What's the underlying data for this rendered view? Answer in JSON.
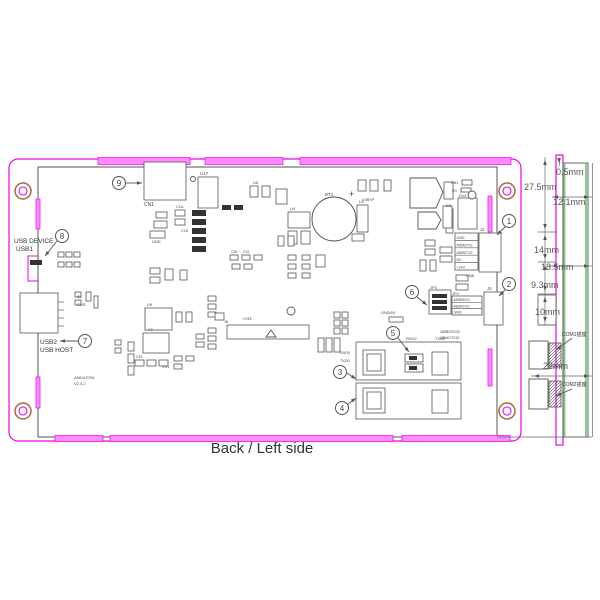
{
  "title": "Back / Left side",
  "colors": {
    "magenta": "#ee00ee",
    "magenta_fill": "#ff8cff",
    "line_gray": "#555555",
    "green": "#7cc97c",
    "hole_ring": "#a86a3a",
    "pad_dark": "#333333"
  },
  "left_labels": {
    "usb_device": "USB DEVICE",
    "usb1": "USB1",
    "usb2": "USB2",
    "usb_host": "USB HOST"
  },
  "side_view": {
    "com1_label": "COM1插座",
    "com2_label": "COM2插座"
  },
  "dimension_labels": [
    {
      "t": "27.5mm",
      "x": 524,
      "y": 190
    },
    {
      "t": "0.5mm",
      "x": 556,
      "y": 175
    },
    {
      "t": "12.1mm",
      "x": 553,
      "y": 205
    },
    {
      "t": "14mm",
      "x": 534,
      "y": 253
    },
    {
      "t": "18.5mm",
      "x": 541,
      "y": 270
    },
    {
      "t": "9.3mm",
      "x": 531,
      "y": 288
    },
    {
      "t": "10mm",
      "x": 535,
      "y": 315
    },
    {
      "t": "22mm",
      "x": 543,
      "y": 369
    }
  ],
  "callouts": [
    {
      "n": "1",
      "cx": 509,
      "cy": 221,
      "x1": 505,
      "y1": 227,
      "x2": 497,
      "y2": 235
    },
    {
      "n": "2",
      "cx": 509,
      "cy": 284,
      "x1": 505,
      "y1": 290,
      "x2": 499,
      "y2": 296
    },
    {
      "n": "3",
      "cx": 340,
      "cy": 372,
      "x1": 347,
      "y1": 373,
      "x2": 356,
      "y2": 379
    },
    {
      "n": "4",
      "cx": 342,
      "cy": 408,
      "x1": 348,
      "y1": 404,
      "x2": 356,
      "y2": 398
    },
    {
      "n": "5",
      "cx": 393,
      "cy": 333,
      "x1": 398,
      "y1": 338,
      "x2": 409,
      "y2": 352
    },
    {
      "n": "6",
      "cx": 412,
      "cy": 292,
      "x1": 417,
      "y1": 297,
      "x2": 427,
      "y2": 305
    },
    {
      "n": "7",
      "cx": 85,
      "cy": 341,
      "x1": 78,
      "y1": 341,
      "x2": 60,
      "y2": 341
    },
    {
      "n": "8",
      "cx": 62,
      "cy": 236,
      "x1": 57,
      "y1": 241,
      "x2": 45,
      "y2": 256
    },
    {
      "n": "9",
      "cx": 119,
      "cy": 183,
      "x1": 126,
      "y1": 183,
      "x2": 142,
      "y2": 183
    }
  ],
  "leader_arrows": [
    {
      "x1": 572,
      "y1": 338,
      "x2": 556,
      "y2": 350
    },
    {
      "x1": 572,
      "y1": 389,
      "x2": 556,
      "y2": 396
    }
  ],
  "dim_arrows": [
    {
      "x": 545,
      "y": 160,
      "dir": "up"
    },
    {
      "x": 545,
      "y": 229,
      "dir": "down"
    },
    {
      "x": 545,
      "y": 235,
      "dir": "up"
    },
    {
      "x": 545,
      "y": 259,
      "dir": "down"
    },
    {
      "x": 545,
      "y": 265,
      "dir": "up"
    },
    {
      "x": 545,
      "y": 291,
      "dir": "down"
    },
    {
      "x": 545,
      "y": 297,
      "dir": "up"
    },
    {
      "x": 545,
      "y": 322,
      "dir": "down"
    },
    {
      "x": 553,
      "y": 197,
      "dir": "left"
    },
    {
      "x": 589,
      "y": 197,
      "dir": "right"
    },
    {
      "x": 552,
      "y": 266,
      "dir": "left"
    },
    {
      "x": 589,
      "y": 266,
      "dir": "right"
    },
    {
      "x": 534,
      "y": 376,
      "dir": "left"
    },
    {
      "x": 589,
      "y": 376,
      "dir": "right"
    },
    {
      "x": 559,
      "y": 163,
      "dir": "down"
    }
  ],
  "connector_tables": [
    {
      "x": 456.5,
      "y0": 239,
      "dy": 7.4,
      "fs": 3.6,
      "pins": [
        "GND",
        "485A/TX2",
        "485B/TX2",
        "NC",
        "+24V"
      ]
    },
    {
      "x": 453.5,
      "y0": 301,
      "dy": 6.3,
      "fs": 3.6,
      "pins": [
        "485B/RX2",
        "485A/TX2",
        "GND"
      ]
    }
  ],
  "ref_labels": [
    {
      "t": "CN1",
      "x": 144,
      "y": 206,
      "s": 5
    },
    {
      "t": "U17",
      "x": 200,
      "y": 175,
      "s": 4.5
    },
    {
      "t": "BT1",
      "x": 325,
      "y": 196,
      "s": 4.5
    },
    {
      "t": "+",
      "x": 349,
      "y": 197,
      "s": 9
    },
    {
      "t": "U4",
      "x": 290,
      "y": 210,
      "s": 4
    },
    {
      "t": "L5",
      "x": 359,
      "y": 203,
      "s": 4
    },
    {
      "t": "V3RXP",
      "x": 362,
      "y": 201,
      "s": 3.8
    },
    {
      "t": "U6",
      "x": 253,
      "y": 184,
      "s": 4
    },
    {
      "t": "FB1",
      "x": 451,
      "y": 184,
      "s": 4
    },
    {
      "t": "R1",
      "x": 452,
      "y": 192,
      "s": 4
    },
    {
      "t": "D14",
      "x": 459,
      "y": 197,
      "s": 4
    },
    {
      "t": "D9",
      "x": 446,
      "y": 207,
      "s": 4
    },
    {
      "t": "J2",
      "x": 480,
      "y": 231,
      "s": 4.5
    },
    {
      "t": "CN6",
      "x": 466,
      "y": 277,
      "s": 4
    },
    {
      "t": "J4",
      "x": 487,
      "y": 290,
      "s": 4.5
    },
    {
      "t": "JP4",
      "x": 452,
      "y": 295,
      "s": 4
    },
    {
      "t": "JP3",
      "x": 430,
      "y": 289,
      "s": 4
    },
    {
      "t": "RXD2",
      "x": 406,
      "y": 340,
      "s": 4
    },
    {
      "t": "TXD2",
      "x": 435,
      "y": 340,
      "s": 4
    },
    {
      "t": "RXD0",
      "x": 340,
      "y": 354,
      "s": 3.8
    },
    {
      "t": "TXD0",
      "x": 340,
      "y": 362,
      "s": 3.8
    },
    {
      "t": "GND/5V",
      "x": 381,
      "y": 314,
      "s": 3.8
    },
    {
      "t": "+V33",
      "x": 242,
      "y": 320,
      "s": 4
    },
    {
      "t": "GND",
      "x": 152,
      "y": 243,
      "s": 3.8
    },
    {
      "t": "CLK",
      "x": 181,
      "y": 232,
      "s": 3.8
    },
    {
      "t": "C1A",
      "x": 176,
      "y": 208,
      "s": 3.8
    },
    {
      "t": "5V",
      "x": 77,
      "y": 298,
      "s": 3.8
    },
    {
      "t": "GND",
      "x": 77,
      "y": 306,
      "s": 3.8
    },
    {
      "t": "VS1",
      "x": 162,
      "y": 368,
      "s": 3.8
    },
    {
      "t": "Y2",
      "x": 148,
      "y": 331,
      "s": 3.8
    },
    {
      "t": "C43",
      "x": 136,
      "y": 358,
      "s": 3.5
    },
    {
      "t": "AMD470FA",
      "x": 74,
      "y": 379,
      "s": 4
    },
    {
      "t": "V2.4.2",
      "x": 74,
      "y": 385,
      "s": 4
    },
    {
      "t": "485B2/RX20",
      "x": 440,
      "y": 333,
      "s": 3.5
    },
    {
      "t": "485A2/TX20",
      "x": 440,
      "y": 339,
      "s": 3.5
    },
    {
      "t": "U9",
      "x": 147,
      "y": 306,
      "s": 4
    },
    {
      "t": "C30",
      "x": 231,
      "y": 253,
      "s": 3.5
    },
    {
      "t": "C31",
      "x": 243,
      "y": 253,
      "s": 3.5
    },
    {
      "t": "J6",
      "x": 224,
      "y": 323,
      "s": 4
    }
  ],
  "shapes": {
    "magenta_bars": [
      [
        98,
        157.5,
        92,
        7
      ],
      [
        205,
        157.5,
        78,
        7
      ],
      [
        300,
        157.5,
        211,
        7
      ],
      [
        55,
        435.5,
        48,
        6
      ],
      [
        110,
        435.5,
        283,
        6
      ],
      [
        402,
        435.5,
        108,
        6
      ],
      [
        36,
        199,
        4,
        30
      ],
      [
        36,
        377,
        4,
        31
      ],
      [
        488,
        196,
        4,
        36
      ],
      [
        488,
        349,
        4,
        37
      ]
    ],
    "holes": [
      [
        23,
        191
      ],
      [
        23,
        411
      ],
      [
        507,
        191
      ],
      [
        507,
        411
      ]
    ],
    "rects": [
      [
        144,
        162,
        42,
        38
      ],
      [
        198,
        177,
        20,
        31
      ],
      [
        288,
        212,
        22,
        16
      ],
      [
        288,
        231,
        9,
        13
      ],
      [
        301,
        231,
        9,
        13
      ],
      [
        357,
        205,
        11,
        27
      ],
      [
        352,
        234,
        12,
        7
      ],
      [
        446,
        209,
        7,
        24
      ],
      [
        444,
        182,
        9,
        17
      ],
      [
        458,
        198,
        19,
        31
      ],
      [
        443,
        206,
        9,
        22
      ],
      [
        462,
        180,
        10,
        5
      ],
      [
        461,
        188,
        10,
        4
      ],
      [
        358,
        180,
        8,
        11
      ],
      [
        370,
        180,
        8,
        11
      ],
      [
        384,
        180,
        7,
        11
      ],
      [
        250,
        186,
        8,
        11
      ],
      [
        262,
        186,
        8,
        11
      ],
      [
        276,
        189,
        11,
        15
      ],
      [
        455,
        233,
        23,
        37
      ],
      [
        479,
        233,
        22,
        39
      ],
      [
        440,
        247,
        12,
        6
      ],
      [
        440,
        256,
        12,
        6
      ],
      [
        425,
        240,
        10,
        6
      ],
      [
        425,
        249,
        10,
        6
      ],
      [
        456,
        275,
        12,
        6
      ],
      [
        456,
        284,
        12,
        6
      ],
      [
        420,
        260,
        6,
        11
      ],
      [
        430,
        260,
        6,
        11
      ],
      [
        452,
        296,
        30,
        19
      ],
      [
        484,
        292,
        19,
        33
      ],
      [
        429,
        290,
        22,
        24
      ],
      [
        356,
        342,
        105,
        38
      ],
      [
        363,
        350,
        22,
        25
      ],
      [
        367,
        354,
        14,
        17
      ],
      [
        405,
        354,
        18,
        8
      ],
      [
        405,
        364,
        18,
        8
      ],
      [
        432,
        352,
        16,
        23
      ],
      [
        356,
        383,
        105,
        36
      ],
      [
        363,
        388,
        22,
        25
      ],
      [
        367,
        392,
        14,
        17
      ],
      [
        432,
        390,
        16,
        23
      ],
      [
        334,
        312,
        6,
        6
      ],
      [
        342,
        312,
        6,
        6
      ],
      [
        334,
        320,
        6,
        6
      ],
      [
        342,
        320,
        6,
        6
      ],
      [
        334,
        328,
        6,
        6
      ],
      [
        342,
        328,
        6,
        6
      ],
      [
        318,
        338,
        6,
        14
      ],
      [
        326,
        338,
        6,
        14
      ],
      [
        334,
        338,
        6,
        14
      ],
      [
        389,
        317,
        14,
        5
      ],
      [
        227,
        325,
        82,
        14
      ],
      [
        208,
        296,
        8,
        5
      ],
      [
        208,
        304,
        8,
        5
      ],
      [
        208,
        312,
        8,
        5
      ],
      [
        208,
        328,
        8,
        5
      ],
      [
        208,
        336,
        8,
        5
      ],
      [
        208,
        344,
        8,
        5
      ],
      [
        215,
        313,
        9,
        7
      ],
      [
        143,
        333,
        26,
        20
      ],
      [
        135,
        360,
        9,
        6
      ],
      [
        147,
        360,
        9,
        6
      ],
      [
        159,
        360,
        9,
        6
      ],
      [
        128,
        342,
        6,
        9
      ],
      [
        128,
        354,
        6,
        9
      ],
      [
        128,
        366,
        6,
        9
      ],
      [
        174,
        356,
        8,
        5
      ],
      [
        186,
        356,
        8,
        5
      ],
      [
        174,
        364,
        8,
        5
      ],
      [
        150,
        268,
        10,
        6
      ],
      [
        150,
        277,
        10,
        6
      ],
      [
        165,
        269,
        8,
        11
      ],
      [
        180,
        270,
        7,
        10
      ],
      [
        145,
        308,
        27,
        22
      ],
      [
        176,
        312,
        6,
        10
      ],
      [
        186,
        312,
        6,
        10
      ],
      [
        156,
        212,
        11,
        6
      ],
      [
        154,
        221,
        13,
        7
      ],
      [
        150,
        231,
        15,
        7
      ],
      [
        175,
        210,
        10,
        6
      ],
      [
        175,
        219,
        10,
        6
      ],
      [
        230,
        255,
        8,
        5
      ],
      [
        242,
        255,
        8,
        5
      ],
      [
        254,
        255,
        8,
        5
      ],
      [
        232,
        264,
        8,
        5
      ],
      [
        244,
        264,
        8,
        5
      ],
      [
        288,
        255,
        8,
        5
      ],
      [
        302,
        255,
        8,
        5
      ],
      [
        288,
        264,
        8,
        5
      ],
      [
        302,
        264,
        8,
        5
      ],
      [
        288,
        273,
        8,
        5
      ],
      [
        302,
        273,
        8,
        5
      ],
      [
        316,
        255,
        9,
        12
      ],
      [
        278,
        236,
        6,
        10
      ],
      [
        288,
        236,
        6,
        10
      ],
      [
        58,
        252,
        6,
        5
      ],
      [
        66,
        252,
        6,
        5
      ],
      [
        74,
        252,
        6,
        5
      ],
      [
        58,
        262,
        6,
        5
      ],
      [
        66,
        262,
        6,
        5
      ],
      [
        74,
        262,
        6,
        5
      ],
      [
        75,
        292,
        6,
        5
      ],
      [
        75,
        300,
        6,
        5
      ],
      [
        86,
        292,
        5,
        9
      ],
      [
        94,
        296,
        4,
        12
      ],
      [
        115,
        340,
        6,
        5
      ],
      [
        115,
        348,
        6,
        5
      ],
      [
        196,
        334,
        8,
        5
      ],
      [
        196,
        342,
        8,
        5
      ],
      [
        20,
        293,
        38,
        40
      ],
      [
        538,
        295,
        18,
        30
      ]
    ],
    "dark_rects": [
      [
        192,
        210,
        14,
        6
      ],
      [
        192,
        219,
        14,
        6
      ],
      [
        192,
        228,
        14,
        6
      ],
      [
        192,
        237,
        14,
        6
      ],
      [
        192,
        246,
        14,
        6
      ],
      [
        409,
        356,
        8,
        4
      ],
      [
        409,
        366,
        8,
        4
      ],
      [
        432,
        294,
        15,
        4
      ],
      [
        432,
        300,
        15,
        4
      ],
      [
        432,
        306,
        15,
        4
      ],
      [
        222,
        205,
        9,
        5
      ],
      [
        234,
        205,
        9,
        5
      ],
      [
        30,
        260,
        12,
        5
      ]
    ],
    "circles": [
      [
        334,
        219,
        22
      ],
      [
        193,
        179,
        2.5
      ],
      [
        291,
        311,
        4
      ],
      [
        472,
        195,
        4
      ]
    ],
    "polys": [
      "410,178 436,178 443,192 436,208 410,208",
      "418,212 436,212 441,220 436,229 418,229",
      "266,337 276,337 271,330"
    ],
    "lines": [
      [
        455,
        240.4,
        478,
        240.4
      ],
      [
        455,
        247.8,
        478,
        247.8
      ],
      [
        455,
        255.2,
        478,
        255.2
      ],
      [
        455,
        262.6,
        478,
        262.6
      ],
      [
        452,
        302.3,
        482,
        302.3
      ],
      [
        452,
        308.6,
        482,
        308.6
      ],
      [
        58,
        302,
        64,
        302
      ],
      [
        58,
        310,
        64,
        310
      ],
      [
        58,
        318,
        64,
        318
      ],
      [
        58,
        326,
        64,
        326
      ],
      [
        545,
        157,
        545,
        232
      ],
      [
        538,
        232,
        556,
        232
      ],
      [
        545,
        232,
        545,
        262
      ],
      [
        538,
        262,
        556,
        262
      ],
      [
        545,
        262,
        545,
        294
      ],
      [
        538,
        294,
        556,
        294
      ],
      [
        545,
        294,
        545,
        325
      ],
      [
        538,
        325,
        556,
        325
      ],
      [
        552,
        197,
        592,
        197
      ],
      [
        549,
        266,
        592,
        266
      ],
      [
        531,
        376,
        592,
        376
      ],
      [
        592.5,
        163,
        592.5,
        437
      ],
      [
        497,
        437,
        592,
        437
      ],
      [
        559,
        166,
        560,
        161
      ]
    ],
    "com_boxes": [
      [
        529,
        341,
        19,
        28
      ],
      [
        529,
        379,
        19,
        30
      ]
    ],
    "com_hatch": [
      [
        549,
        343,
        12,
        24
      ],
      [
        549,
        381,
        12,
        26
      ]
    ]
  }
}
